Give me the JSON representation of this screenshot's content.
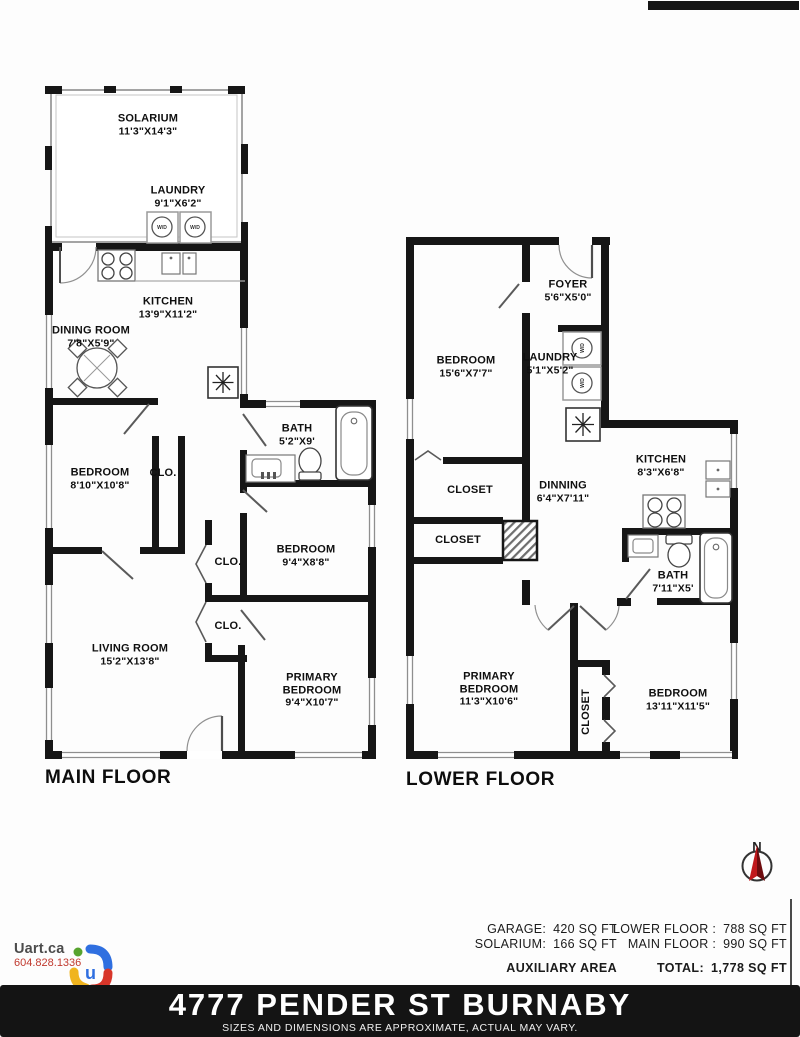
{
  "decor": {
    "wd_label": "W/D",
    "north_label": "N"
  },
  "floors": [
    {
      "title": "MAIN FLOOR",
      "rooms": [
        {
          "label": "SOLARIUM",
          "dims": "11'3\"X14'3\""
        },
        {
          "label": "LAUNDRY",
          "dims": "9'1\"X6'2\""
        },
        {
          "label": "KITCHEN",
          "dims": "13'9\"X11'2\""
        },
        {
          "label": "DINING ROOM",
          "dims": "7'8\"X5'9\""
        },
        {
          "label": "BEDROOM",
          "dims": "8'10\"X10'8\""
        },
        {
          "label": "CLO.",
          "dims": ""
        },
        {
          "label": "BATH",
          "dims": "5'2\"X9'"
        },
        {
          "label": "BEDROOM",
          "dims": "9'4\"X8'8\""
        },
        {
          "label": "CLO.",
          "dims": ""
        },
        {
          "label": "CLO.",
          "dims": ""
        },
        {
          "label": "LIVING ROOM",
          "dims": "15'2\"X13'8\""
        },
        {
          "label": "PRIMARY\nBEDROOM",
          "dims": "9'4\"X10'7\""
        }
      ]
    },
    {
      "title": "LOWER FLOOR",
      "rooms": [
        {
          "label": "BEDROOM",
          "dims": "15'6\"X7'7\""
        },
        {
          "label": "FOYER",
          "dims": "5'6\"X5'0\""
        },
        {
          "label": "LAUNDRY",
          "dims": "5'1\"X5'2\""
        },
        {
          "label": "KITCHEN",
          "dims": "8'3\"X6'8\""
        },
        {
          "label": "CLOSET",
          "dims": ""
        },
        {
          "label": "CLOSET",
          "dims": ""
        },
        {
          "label": "DINNING",
          "dims": "6'4\"X7'11\""
        },
        {
          "label": "BATH",
          "dims": "7'11\"X5'"
        },
        {
          "label": "PRIMARY\nBEDROOM",
          "dims": "11'3\"X10'6\""
        },
        {
          "label": "CLOSET",
          "dims": ""
        },
        {
          "label": "BEDROOM",
          "dims": "13'11\"X11'5\""
        }
      ]
    }
  ],
  "branding": {
    "site": "Uart.ca",
    "phone": "604.828.1336",
    "logo_letter": "u"
  },
  "area_table": {
    "left_rows": [
      {
        "label": "GARAGE:",
        "value": "420 SQ FT"
      },
      {
        "label": "SOLARIUM:",
        "value": "166 SQ FT"
      }
    ],
    "right_rows": [
      {
        "label": "LOWER FLOOR :",
        "value": "788 SQ FT"
      },
      {
        "label": "MAIN FLOOR :",
        "value": "990 SQ FT"
      }
    ],
    "left_footer": "AUXILIARY AREA",
    "total_label": "TOTAL:",
    "total_value": "1,778 SQ FT"
  },
  "footer": {
    "address": "4777 PENDER ST BURNABY",
    "disclaimer": "SIZES AND DIMENSIONS ARE APPROXIMATE, ACTUAL MAY VARY."
  }
}
